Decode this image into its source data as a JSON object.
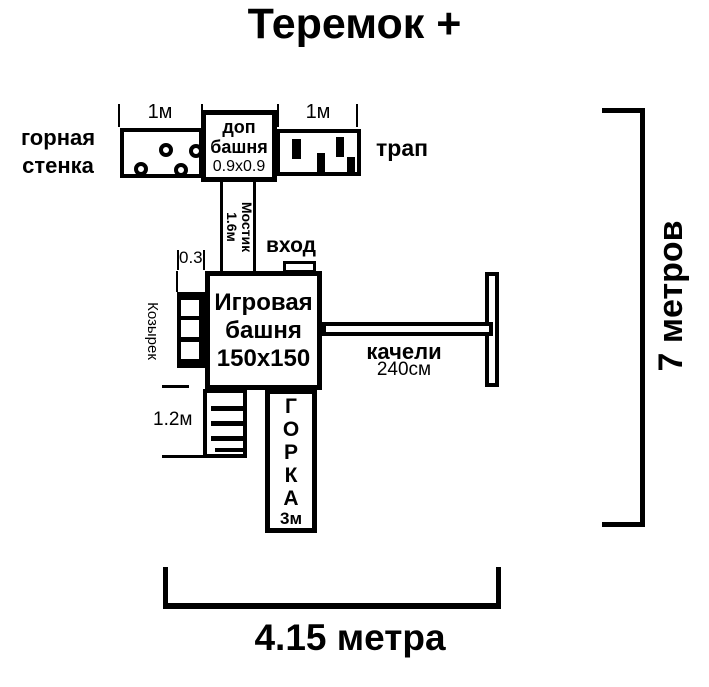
{
  "title": "Теремок +",
  "colors": {
    "ink": "#000000",
    "paper": "#ffffff"
  },
  "climbing_wall": {
    "label_line1": "горная",
    "label_line2": "стенка",
    "dim": "1м"
  },
  "extra_tower": {
    "line1": "доп",
    "line2": "башня",
    "line3": "0.9х0.9"
  },
  "ramp": {
    "label": "трап",
    "dim": "1м"
  },
  "bridge": {
    "line1": "Мостик",
    "line2": "1.6м"
  },
  "entrance": {
    "label": "вход"
  },
  "main_tower": {
    "line1": "Игровая",
    "line2": "башня",
    "line3": "150х150"
  },
  "canopy": {
    "label": "Козырек",
    "dim": "0.3"
  },
  "swing": {
    "label": "качели",
    "dim": "240см"
  },
  "ladder": {
    "dim": "1.2м"
  },
  "slide": {
    "letters": [
      "Г",
      "О",
      "Р",
      "К",
      "А"
    ],
    "dim": "3м"
  },
  "overall": {
    "height_label": "7 метров",
    "width_label": "4.15 метра"
  }
}
